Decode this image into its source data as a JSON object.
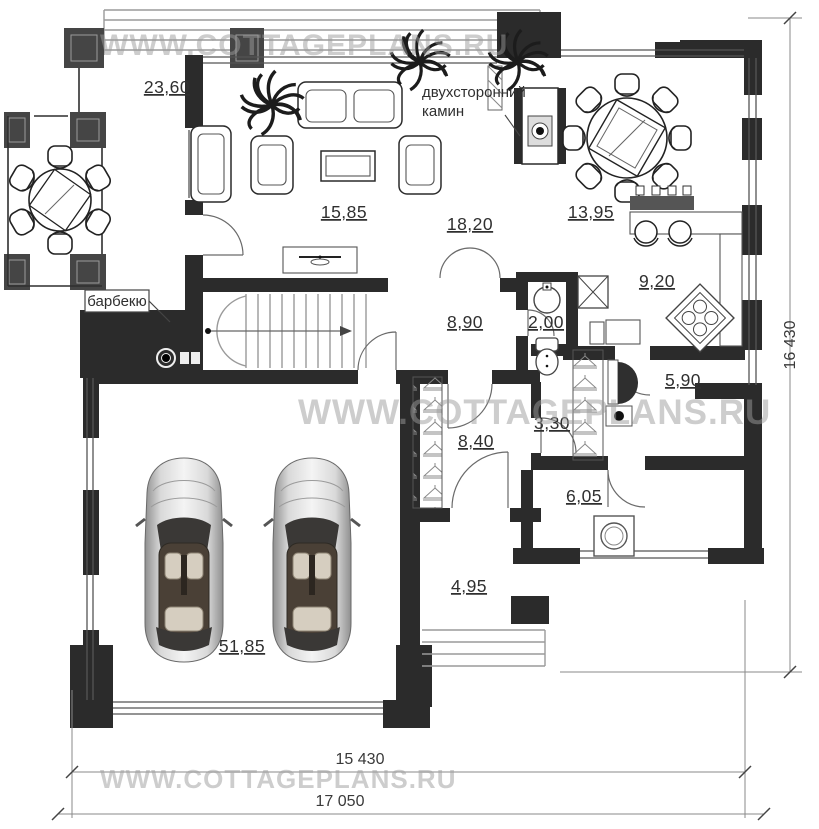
{
  "watermark": {
    "text": "WWW.COTTAGEPLANS.RU"
  },
  "annotations": {
    "fireplace_label_line1": "двухсторонний",
    "fireplace_label_line2": "камин",
    "barbecue_label": "барбекю"
  },
  "rooms": {
    "terrace": {
      "label": "23,60"
    },
    "living_room": {
      "label": "15,85"
    },
    "hall": {
      "label": "18,20"
    },
    "dining_room": {
      "label": "13,95"
    },
    "kitchen": {
      "label": "9,20"
    },
    "corridor": {
      "label": "8,90"
    },
    "wc": {
      "label": "2,00"
    },
    "bathroom": {
      "label": "5,90"
    },
    "wardrobe": {
      "label": "3,30"
    },
    "entry_hall": {
      "label": "8,40"
    },
    "laundry": {
      "label": "6,05"
    },
    "porch": {
      "label": "4,95"
    },
    "garage": {
      "label": "51,85"
    }
  },
  "dimensions": {
    "height_total": "16 430",
    "width_inner": "15 430",
    "width_total": "17 050"
  },
  "colors": {
    "wall": "#2b2b2b",
    "terrace_wall": "#454545",
    "watermark": "#9c9c9c",
    "background": "#ffffff"
  }
}
